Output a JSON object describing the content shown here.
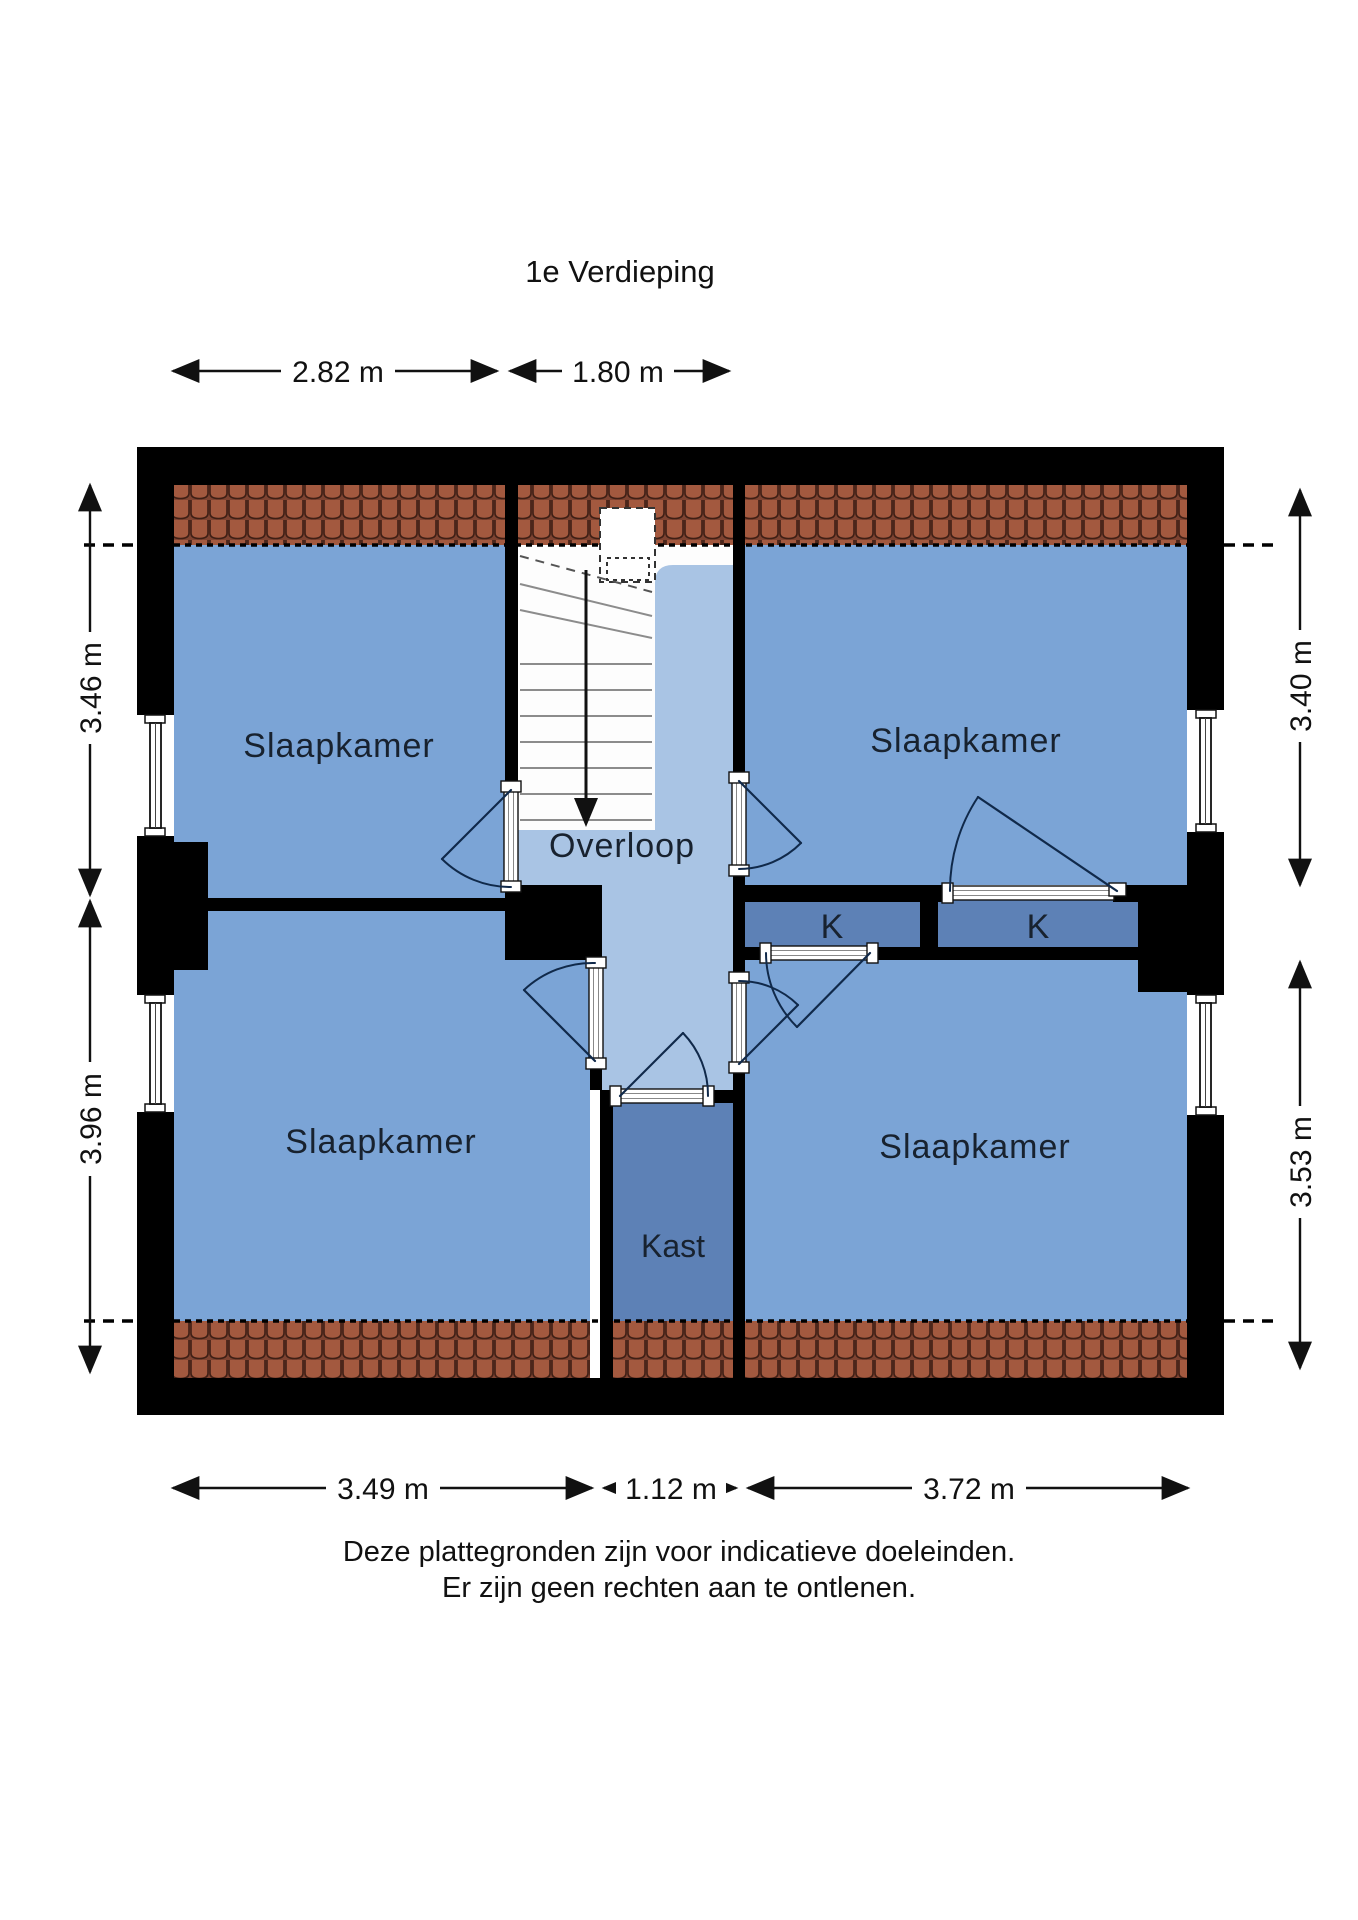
{
  "title": "1e Verdieping",
  "rooms": {
    "bedroom_tl": "Slaapkamer",
    "bedroom_tr": "Slaapkamer",
    "bedroom_bl": "Slaapkamer",
    "bedroom_br": "Slaapkamer",
    "landing": "Overloop",
    "closet": "Kast",
    "closet_k_left": "K",
    "closet_k_right": "K"
  },
  "dimensions": {
    "top": [
      "2.82 m",
      "1.80 m"
    ],
    "left": [
      "3.46 m",
      "3.96 m"
    ],
    "right": [
      "3.40 m",
      "3.53 m"
    ],
    "bottom": [
      "3.49 m",
      "1.12 m",
      "3.72 m"
    ]
  },
  "footer": [
    "Deze plattegronden zijn voor indicatieve doeleinden.",
    "Er zijn geen rechten aan te ontlenen."
  ],
  "colors": {
    "room_blue": "#7ba4d6",
    "landing_blue": "#a9c4e4",
    "closet_blue": "#5d81b6",
    "wall_black": "#000000",
    "roof_tile": "#a3593f",
    "roof_tile_dark": "#3f1f15",
    "door_line": "#10294a",
    "text_dark": "#18222f"
  }
}
